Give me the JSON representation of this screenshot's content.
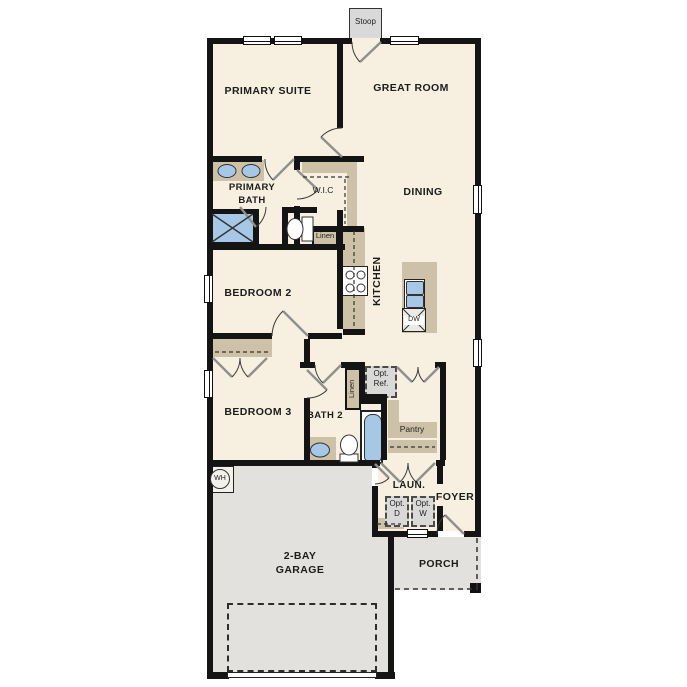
{
  "plan": {
    "colors": {
      "wall": "#141414",
      "floor": "#f7f0e1",
      "tan": "#cdc2a7",
      "gray": "#e2e1dd",
      "fixture_blue": "#a7c7e6",
      "optional_gray": "#d9d9d8"
    },
    "labels": {
      "stoop": "Stoop",
      "primary_suite": "PRIMARY SUITE",
      "great_room": "GREAT ROOM",
      "dining": "DINING",
      "primary_bath": "PRIMARY BATH",
      "wic": "W.I.C",
      "linen_primary": "Linen",
      "kitchen": "KITCHEN",
      "bedroom2": "BEDROOM 2",
      "bedroom3": "BEDROOM 3",
      "bath2": "BATH 2",
      "linen_hall": "Linen",
      "opt_ref": "Opt. Ref.",
      "pantry": "Pantry",
      "laundry": "LAUN.",
      "opt_dryer": "Opt. D",
      "opt_washer": "Opt. W",
      "foyer": "FOYER",
      "porch": "PORCH",
      "garage": "2-BAY GARAGE",
      "water_heater": "WH",
      "dishwasher": "DW"
    }
  }
}
